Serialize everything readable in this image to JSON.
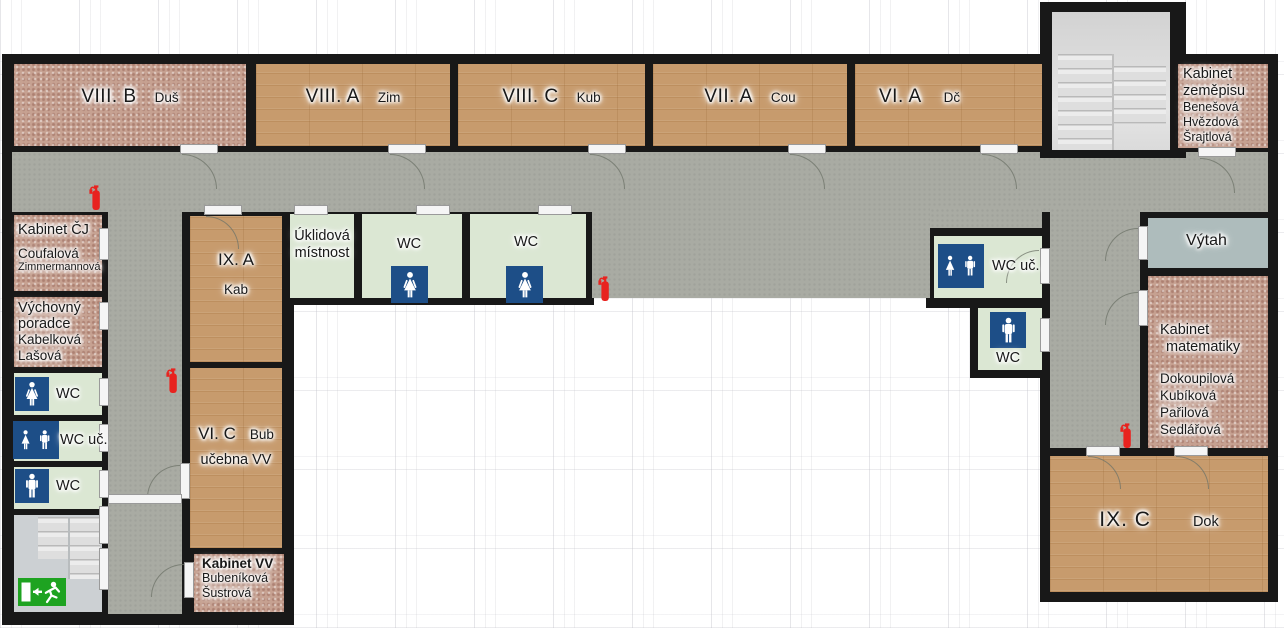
{
  "page_title": "School floor plan",
  "palette": {
    "wall": "#181818",
    "corridor": "#a9aba3",
    "classroom_wood": "#c79b6d",
    "office_masonry": "#c6a191",
    "wc_green": "#dbe7d3",
    "elevator_gray": "#aebcbc",
    "wc_sign_blue": "#1d4e87",
    "exit_sign_green": "#1ea321",
    "fire_extinguisher_red": "#e8231f"
  },
  "icons": {
    "fire_extinguisher": "red extinguisher pictogram",
    "women_wc": "white woman figure on blue tile",
    "men_wc": "white man figure on blue tile",
    "unisex_wc": "white woman+man figures on blue tile",
    "emergency_exit": "green sign: door, left arrow, running man",
    "stairs": "stair treads",
    "door": "white door gap in wall",
    "door_swing_arc": "quarter-circle swing arc"
  },
  "rooms": {
    "viii_b": {
      "code": "VIII. B",
      "teacher": "Duš"
    },
    "viii_a": {
      "code": "VIII. A",
      "teacher": "Zim"
    },
    "viii_c": {
      "code": "VIII. C",
      "teacher": "Kub"
    },
    "vii_a": {
      "code": "VII. A",
      "teacher": "Cou"
    },
    "vi_a": {
      "code": "VI. A",
      "teacher": "Dč"
    },
    "kabinet_zemepisu": {
      "title_line1": "Kabinet",
      "title_line2": "zeměpisu",
      "staff": [
        "Benešová",
        "Hvězdová",
        "Šrajtlová"
      ]
    },
    "kabinet_cj": {
      "title": "Kabinet ČJ",
      "staff": [
        "Coufalová",
        "Zimmermannová"
      ]
    },
    "vychovny_poradce": {
      "title_line1": "Výchovný",
      "title_line2": "poradce",
      "staff": [
        "Kabelková",
        "Lašová"
      ]
    },
    "wc_left_women": {
      "label": "WC"
    },
    "wc_left_teachers": {
      "label": "WC uč."
    },
    "wc_left_men": {
      "label": "WC"
    },
    "ix_a": {
      "code": "IX. A",
      "teacher": "Kab"
    },
    "uklidova_mistnost": {
      "line1": "Úklidová",
      "line2": "místnost"
    },
    "wc_mid_1": {
      "label": "WC"
    },
    "wc_mid_2": {
      "label": "WC"
    },
    "vi_c": {
      "code": "VI. C",
      "teacher": "Bub",
      "subtitle": "učebna VV"
    },
    "kabinet_vv": {
      "title": "Kabinet VV",
      "staff": [
        "Bubeníková",
        "Šustrová"
      ]
    },
    "wc_right_teachers": {
      "label": "WC uč."
    },
    "wc_right_men": {
      "label": "WC"
    },
    "vytah": {
      "label": "Výtah"
    },
    "kabinet_matematiky": {
      "title_line1": "Kabinet",
      "title_line2": "matematiky",
      "staff": [
        "Dokoupilová",
        "Kubíková",
        "Pařilová",
        "Sedlářová"
      ]
    },
    "ix_c": {
      "code": "IX. C",
      "teacher": "Dok"
    }
  }
}
